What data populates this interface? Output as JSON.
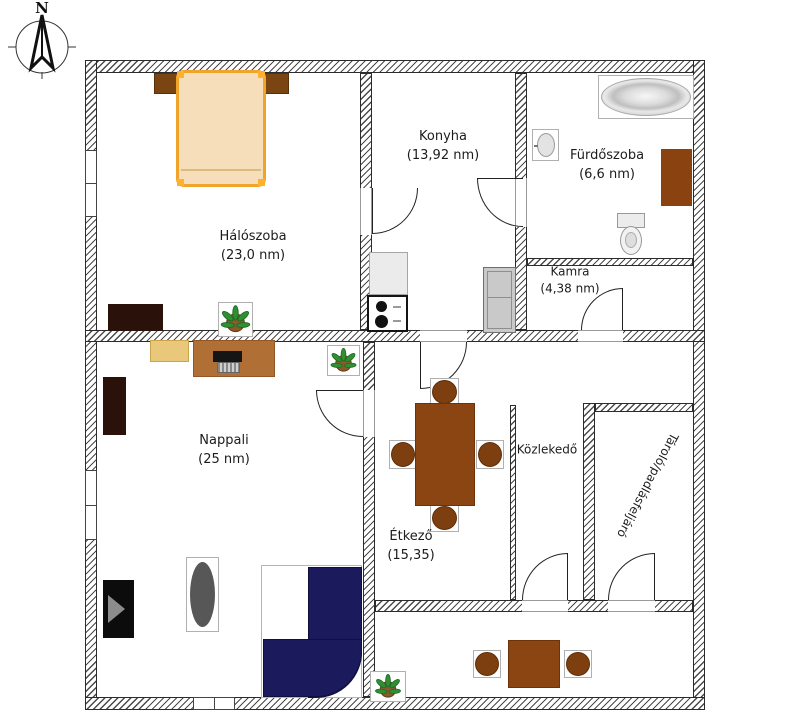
{
  "compass": {
    "label": "N"
  },
  "rooms": {
    "halo": {
      "name": "Hálószoba",
      "area": "(23,0 nm)"
    },
    "konyha": {
      "name": "Konyha",
      "area": "(13,92 nm)"
    },
    "furdo": {
      "name": "Fürdőszoba",
      "area": "(6,6 nm)"
    },
    "kamra": {
      "name": "Kamra",
      "area": "(4,38 nm)"
    },
    "nappali": {
      "name": "Nappali",
      "area": "(25 nm)"
    },
    "etkezo": {
      "name": "Étkező",
      "area": "(15,35)"
    },
    "kozlekedo": {
      "name": "Közlekedő"
    },
    "tarolo": {
      "name": "Tároló/padlásfeljáró"
    }
  },
  "colors": {
    "wall-line": "#2b2b2b",
    "hatch": "#4a4a4a",
    "brown": "#8b4513",
    "brown-dark": "#6d3208",
    "chair": "#7d3f10",
    "sofa": "#1a1a5c",
    "bed-frame": "#f0a42c",
    "bed-fill": "#f5deb9",
    "sideboard": "#b06f35",
    "desk": "#e9c77b",
    "dark-cab": "#2a110a",
    "tub-gray": "#cdcdcd"
  }
}
